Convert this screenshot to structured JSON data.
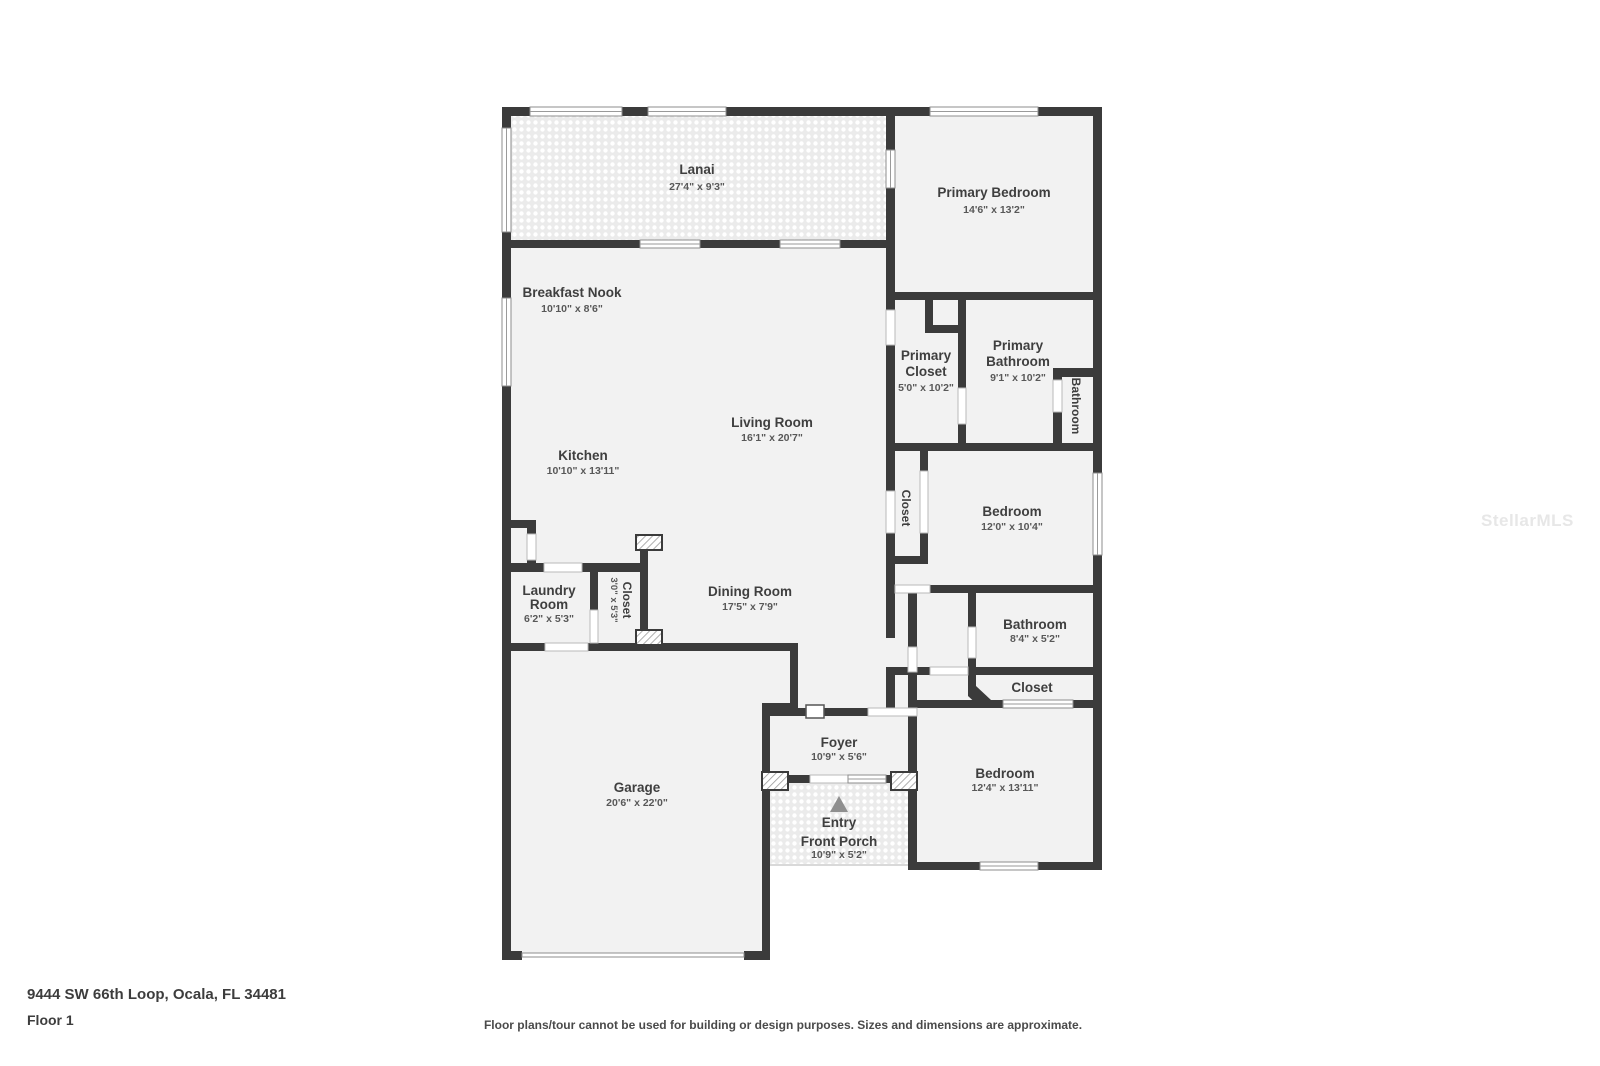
{
  "watermark": "StellarMLS",
  "footer": {
    "address": "9444 SW 66th Loop, Ocala, FL 34481",
    "floor_label": "Floor 1",
    "disclaimer": "Floor plans/tour cannot be used for building or design purposes. Sizes and dimensions are approximate."
  },
  "colors": {
    "wall": "#3b3b3b",
    "room_fill": "#f2f2f2",
    "room_name_text": "#3f3f3f",
    "room_dims_text": "#585858"
  },
  "rooms": {
    "lanai": {
      "name": "Lanai",
      "dims": "27'4\" x 9'3\""
    },
    "primary_bedroom": {
      "name": "Primary Bedroom",
      "dims": "14'6\" x 13'2\""
    },
    "breakfast_nook": {
      "name": "Breakfast Nook",
      "dims": "10'10\" x 8'6\""
    },
    "primary_closet": {
      "name1": "Primary",
      "name2": "Closet",
      "dims": "5'0\" x 10'2\""
    },
    "primary_bathroom": {
      "name1": "Primary",
      "name2": "Bathroom",
      "dims": "9'1\" x 10'2\""
    },
    "bathroom_small": {
      "name": "Bathroom"
    },
    "living_room": {
      "name": "Living Room",
      "dims": "16'1\" x 20'7\""
    },
    "kitchen": {
      "name": "Kitchen",
      "dims": "10'10\" x 13'11\""
    },
    "closet_bedroom2": {
      "name": "Closet"
    },
    "bedroom2": {
      "name": "Bedroom",
      "dims": "12'0\" x 10'4\""
    },
    "laundry": {
      "name1": "Laundry",
      "name2": "Room",
      "dims": "6'2\" x 5'3\""
    },
    "closet_hall": {
      "name": "Closet",
      "dims": "3'0\" x 5'3\""
    },
    "dining_room": {
      "name": "Dining Room",
      "dims": "17'5\" x 7'9\""
    },
    "bathroom2": {
      "name": "Bathroom",
      "dims": "8'4\" x 5'2\""
    },
    "closet_bedroom3": {
      "name": "Closet"
    },
    "foyer": {
      "name": "Foyer",
      "dims": "10'9\" x 5'6\""
    },
    "bedroom3": {
      "name": "Bedroom",
      "dims": "12'4\" x 13'11\""
    },
    "entry": {
      "name": "Entry"
    },
    "front_porch": {
      "name": "Front Porch",
      "dims": "10'9\" x 5'2\""
    },
    "garage": {
      "name": "Garage",
      "dims": "20'6\" x 22'0\""
    }
  }
}
